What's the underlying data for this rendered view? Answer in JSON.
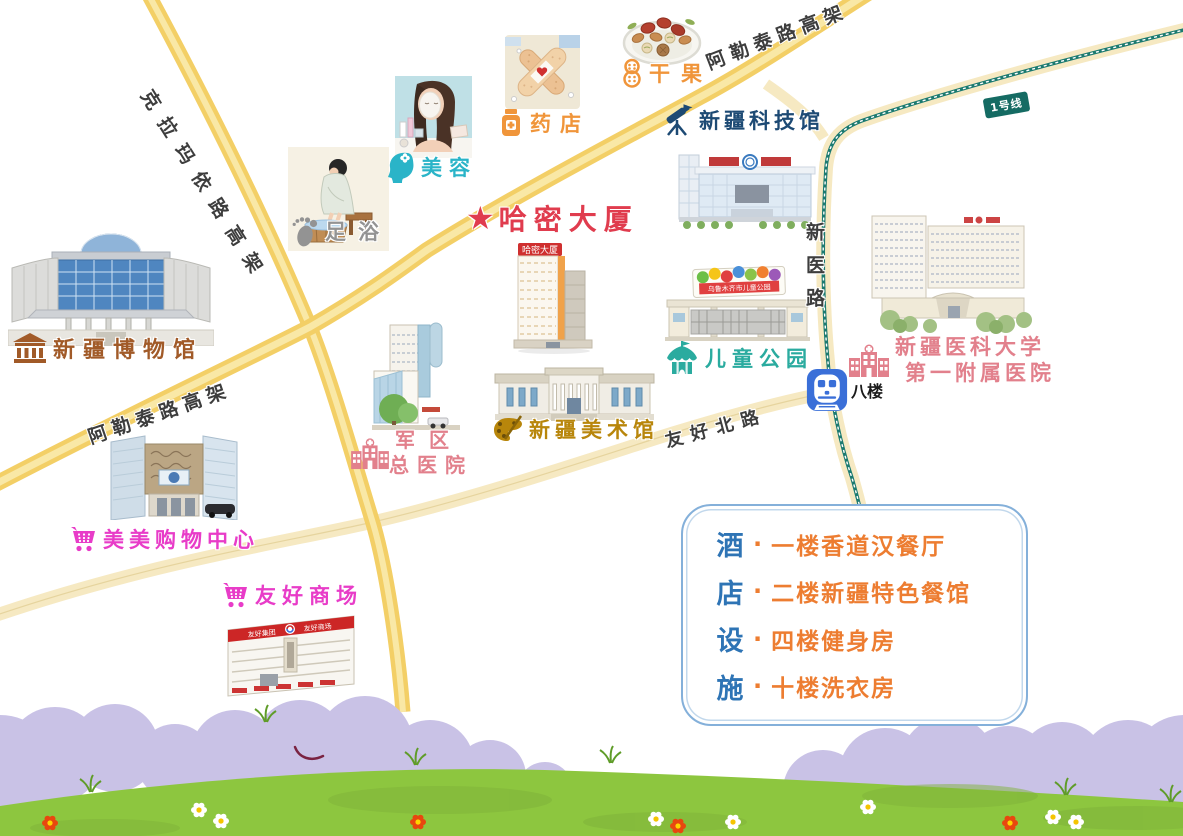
{
  "roads": {
    "kelamayi": "克拉玛依路高架",
    "aletai_top": "阿勒泰路高架",
    "aletai_left": "阿勒泰路高架",
    "xinyi": "新医路",
    "youhao_north": "友好北路",
    "metro_line": "1号线"
  },
  "station": {
    "label": "八楼"
  },
  "pois": {
    "museum": {
      "label": "新疆博物馆"
    },
    "footbath": {
      "label": "足浴"
    },
    "beauty": {
      "label": "美容"
    },
    "pharmacy": {
      "label": "药店"
    },
    "nuts": {
      "label": "干果"
    },
    "science": {
      "label": "新疆科技馆"
    },
    "hotel": {
      "star": "★",
      "label": "哈密大厦",
      "sign": "哈密大厦"
    },
    "art": {
      "label": "新疆美术馆"
    },
    "park": {
      "label": "儿童公园",
      "gate_sign": "乌鲁木齐市儿童公园"
    },
    "med_univ_hospital": {
      "line1": "新疆医科大学",
      "line2": "第一附属医院"
    },
    "military_hospital": {
      "line1": "军区",
      "line2": "总医院"
    },
    "meimei_mall": {
      "label": "美美购物中心"
    },
    "youhao_mall": {
      "label": "友好商场",
      "banner_left": "友好集团",
      "banner_right": "友好商场"
    }
  },
  "legend": {
    "title_chars": [
      "酒",
      "店",
      "设",
      "施"
    ],
    "bullet": "·",
    "items": [
      "一楼香道汉餐厅",
      "二楼新疆特色餐馆",
      "四楼健身房",
      "十楼洗衣房"
    ]
  },
  "colors": {
    "hotel_red": "#e03c4e",
    "teal_beauty": "#2ab4c8",
    "teal_park": "#2aab9f",
    "orange": "#f0953a",
    "navy": "#1d4a74",
    "brown": "#a15a28",
    "pink": "#e2808c",
    "magenta": "#e83cc8",
    "gray": "#939393",
    "gold": "#b8860b",
    "road_yellow": "#f3cf66",
    "road_pale": "#f6e9c2",
    "metro_teal": "#1b7a70",
    "station_blue": "#3a6fd8",
    "legend_blue": "#2e74b5",
    "legend_item_orange": "#ed7d31",
    "legend_border": "#84b0da",
    "grass_green": "#8dc63f",
    "bush_purple": "#c9c2e6"
  }
}
